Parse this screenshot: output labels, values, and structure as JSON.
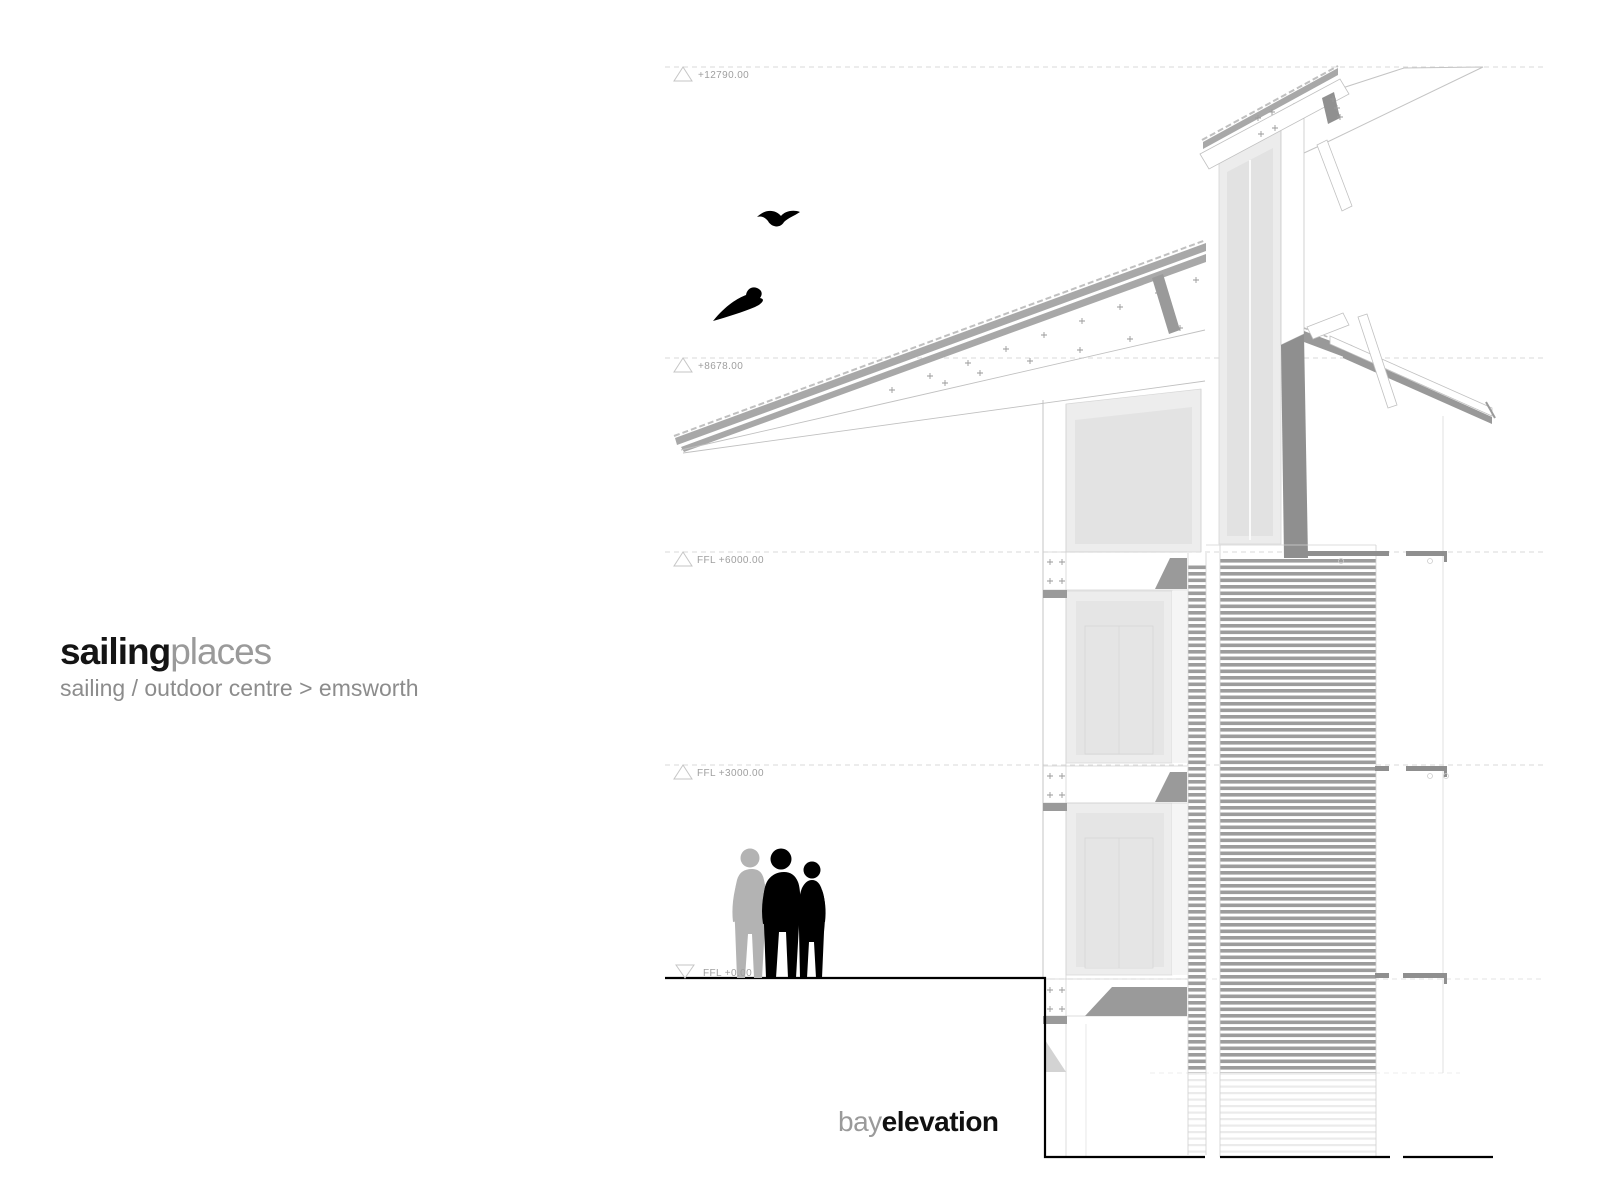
{
  "title": {
    "primary_bold": "sailing",
    "primary_light": "places",
    "subtitle": "sailing / outdoor centre > emsworth"
  },
  "drawing_label": {
    "light_part": "bay",
    "bold_part": "elevation"
  },
  "levels": [
    {
      "id": "level-12790",
      "label": "+12790.00",
      "marker": "triangle-up-outline"
    },
    {
      "id": "level-8678",
      "label": "+8678.00",
      "marker": "triangle-up-outline"
    },
    {
      "id": "level-6000",
      "label": "FFL +6000.00",
      "marker": "triangle-up-outline"
    },
    {
      "id": "level-3000",
      "label": "FFL +3000.00",
      "marker": "triangle-up-outline"
    },
    {
      "id": "level-0",
      "label": "FFL +0.00",
      "marker": "triangle-down-outline"
    }
  ],
  "scene": {
    "drawing_type": "bay elevation, sailing / outdoor centre",
    "birds_count": 2,
    "people_count": 3
  },
  "colors": {
    "background": "#ffffff",
    "ink": "#000000",
    "title_gray": "#9a9a9a",
    "line_gray": "#c0c0c0",
    "roof_gray": "#a8a8a8",
    "shadow_gray": "#8f8f8f",
    "louver_gray": "#9c9c9c",
    "glazing_light": "#ededed",
    "glazing_mid": "#e3e3e3",
    "dashed_line": "#d9d9d9",
    "label_gray": "#9f9f9f"
  }
}
